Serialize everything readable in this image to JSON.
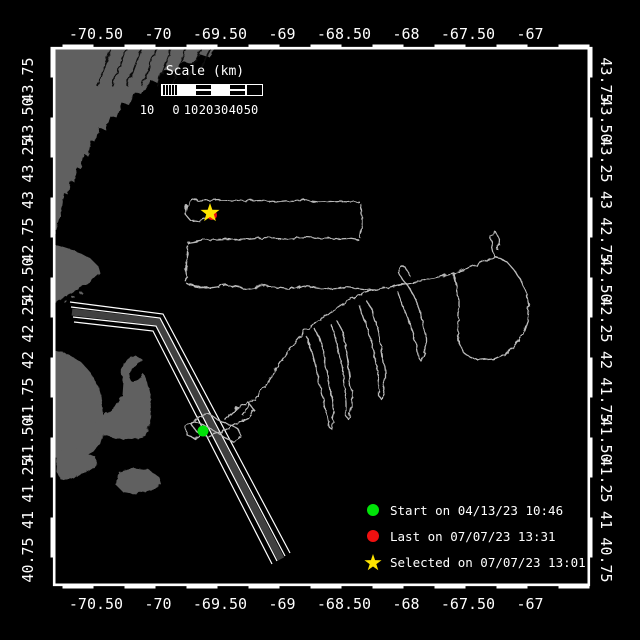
{
  "axes": {
    "lon_labels": [
      "-70.50",
      "-70",
      "-69.50",
      "-69",
      "-68.50",
      "-68",
      "-67.50",
      "-67"
    ],
    "lat_labels": [
      "43.75",
      "43.50",
      "43.25",
      "43",
      "42.75",
      "42.50",
      "42.25",
      "42",
      "41.75",
      "41.50",
      "41.25",
      "41",
      "40.75"
    ]
  },
  "scale_bar": {
    "title": "Scale (km)",
    "tick_labels": [
      "10",
      "0",
      "10",
      "20",
      "30",
      "40",
      "50"
    ],
    "segment_styles": [
      "hatch",
      "solid",
      "stripe",
      "solid",
      "stripe",
      "hollow"
    ]
  },
  "legend": {
    "items": [
      {
        "marker": "start-dot",
        "shape": "dot",
        "color": "#00e408",
        "label": "Start on 04/13/23 10:46"
      },
      {
        "marker": "last-dot",
        "shape": "dot",
        "color": "#f01010",
        "label": "Last on 07/07/23 13:31"
      },
      {
        "marker": "selected-star",
        "shape": "star",
        "color": "#ffe400",
        "label": "Selected on 07/07/23 13:01"
      }
    ]
  },
  "map": {
    "colors": {
      "background": "#000000",
      "land": "#606060",
      "river": "#0a0a0a",
      "track": "#bbbbbb",
      "frame": "#ffffff",
      "corridor_band": "#404040",
      "corridor_line": "#ffffff",
      "start": "#00e408",
      "last": "#f01010",
      "selected": "#ffe400"
    },
    "markers": {
      "start": {
        "x": 203,
        "y": 431,
        "r": 5.5
      },
      "last": {
        "x": 212,
        "y": 215,
        "r": 5
      },
      "selected": {
        "x": 210,
        "y": 213,
        "R": 10,
        "r": 4
      }
    },
    "land": [
      [
        [
          53,
          47
        ],
        [
          215,
          47
        ],
        [
          208,
          56
        ],
        [
          199,
          53
        ],
        [
          191,
          63
        ],
        [
          182,
          60
        ],
        [
          173,
          72
        ],
        [
          163,
          69
        ],
        [
          157,
          82
        ],
        [
          149,
          79
        ],
        [
          141,
          94
        ],
        [
          133,
          91
        ],
        [
          128,
          104
        ],
        [
          121,
          102
        ],
        [
          116,
          117
        ],
        [
          109,
          115
        ],
        [
          104,
          129
        ],
        [
          98,
          127
        ],
        [
          95,
          142
        ],
        [
          90,
          140
        ],
        [
          87,
          155
        ],
        [
          83,
          153
        ],
        [
          80,
          168
        ],
        [
          76,
          166
        ],
        [
          73,
          181
        ],
        [
          70,
          179
        ],
        [
          67,
          194
        ],
        [
          63,
          192
        ],
        [
          61,
          207
        ],
        [
          58,
          218
        ],
        [
          55,
          228
        ],
        [
          53,
          236
        ]
      ],
      [
        [
          53,
          243
        ],
        [
          66,
          247
        ],
        [
          79,
          252
        ],
        [
          90,
          258
        ],
        [
          97,
          265
        ],
        [
          99,
          272
        ],
        [
          92,
          279
        ],
        [
          82,
          285
        ],
        [
          70,
          292
        ],
        [
          59,
          298
        ],
        [
          53,
          302
        ]
      ],
      [
        [
          53,
          349
        ],
        [
          67,
          353
        ],
        [
          80,
          361
        ],
        [
          90,
          372
        ],
        [
          97,
          385
        ],
        [
          101,
          399
        ],
        [
          103,
          414
        ],
        [
          103,
          429
        ],
        [
          99,
          441
        ],
        [
          92,
          450
        ],
        [
          81,
          456
        ],
        [
          68,
          458
        ],
        [
          56,
          457
        ],
        [
          53,
          456
        ]
      ],
      [
        [
          88,
          426
        ],
        [
          102,
          416
        ],
        [
          114,
          406
        ],
        [
          121,
          394
        ],
        [
          122,
          380
        ],
        [
          120,
          368
        ],
        [
          125,
          359
        ],
        [
          134,
          354
        ],
        [
          141,
          358
        ],
        [
          137,
          365
        ],
        [
          130,
          368
        ],
        [
          128,
          376
        ],
        [
          132,
          382
        ],
        [
          138,
          379
        ],
        [
          142,
          372
        ],
        [
          146,
          379
        ],
        [
          149,
          393
        ],
        [
          150,
          409
        ],
        [
          149,
          425
        ],
        [
          144,
          435
        ],
        [
          132,
          439
        ],
        [
          116,
          438
        ],
        [
          101,
          433
        ]
      ],
      [
        [
          58,
          449
        ],
        [
          75,
          448
        ],
        [
          95,
          456
        ],
        [
          97,
          463
        ],
        [
          85,
          471
        ],
        [
          70,
          477
        ],
        [
          60,
          479
        ],
        [
          55,
          470
        ],
        [
          56,
          456
        ]
      ],
      [
        [
          118,
          471
        ],
        [
          133,
          467
        ],
        [
          148,
          469
        ],
        [
          158,
          476
        ],
        [
          160,
          483
        ],
        [
          150,
          489
        ],
        [
          135,
          493
        ],
        [
          122,
          491
        ],
        [
          115,
          484
        ],
        [
          116,
          476
        ]
      ]
    ],
    "islets": [
      [
        64,
        300
      ],
      [
        72,
        296
      ],
      [
        80,
        292
      ]
    ],
    "rivers": [
      [
        [
          110,
          47
        ],
        [
          96,
          85
        ]
      ],
      [
        [
          125,
          47
        ],
        [
          111,
          85
        ]
      ],
      [
        [
          140,
          47
        ],
        [
          126,
          85
        ]
      ],
      [
        [
          155,
          47
        ],
        [
          141,
          85
        ]
      ],
      [
        [
          170,
          47
        ],
        [
          156,
          85
        ]
      ],
      [
        [
          185,
          47
        ],
        [
          171,
          85
        ]
      ],
      [
        [
          200,
          47
        ],
        [
          186,
          78
        ]
      ],
      [
        [
          210,
          47
        ],
        [
          200,
          66
        ]
      ]
    ],
    "corridor": {
      "outer1": [
        [
          70,
          302
        ],
        [
          163,
          314
        ],
        [
          290,
          553
        ]
      ],
      "edge1": [
        [
          71,
          307
        ],
        [
          160,
          318
        ],
        [
          285,
          556
        ]
      ],
      "center": [
        [
          72,
          312
        ],
        [
          158,
          322
        ],
        [
          281,
          559
        ]
      ],
      "edge2": [
        [
          73,
          317
        ],
        [
          156,
          326
        ],
        [
          277,
          561
        ]
      ],
      "outer2": [
        [
          74,
          322
        ],
        [
          153,
          331
        ],
        [
          272,
          564
        ]
      ]
    },
    "track": [
      [
        [
          203,
          431
        ],
        [
          194,
          438
        ],
        [
          186,
          434
        ],
        [
          184,
          426
        ],
        [
          192,
          420
        ],
        [
          203,
          424
        ],
        [
          213,
          430
        ],
        [
          223,
          436
        ],
        [
          233,
          441
        ],
        [
          241,
          436
        ],
        [
          237,
          428
        ],
        [
          227,
          423
        ],
        [
          217,
          419
        ],
        [
          208,
          413
        ],
        [
          198,
          415
        ],
        [
          190,
          423
        ],
        [
          196,
          431
        ],
        [
          207,
          436
        ],
        [
          218,
          432
        ],
        [
          228,
          427
        ],
        [
          238,
          421
        ],
        [
          247,
          417
        ],
        [
          253,
          409
        ],
        [
          248,
          402
        ],
        [
          239,
          405
        ],
        [
          231,
          412
        ],
        [
          224,
          419
        ]
      ],
      [
        [
          241,
          414
        ],
        [
          247,
          406
        ],
        [
          254,
          398
        ],
        [
          261,
          389
        ],
        [
          267,
          380
        ],
        [
          273,
          371
        ],
        [
          279,
          362
        ],
        [
          285,
          353
        ],
        [
          292,
          344
        ],
        [
          298,
          337
        ],
        [
          304,
          331
        ]
      ],
      [
        [
          304,
          331
        ],
        [
          316,
          321
        ],
        [
          328,
          312
        ],
        [
          340,
          304
        ],
        [
          352,
          297
        ],
        [
          364,
          291
        ],
        [
          373,
          289
        ]
      ],
      [
        [
          187,
          284
        ],
        [
          205,
          287
        ],
        [
          225,
          284
        ],
        [
          245,
          288
        ],
        [
          265,
          285
        ],
        [
          285,
          288
        ],
        [
          305,
          285
        ],
        [
          325,
          288
        ],
        [
          345,
          286
        ],
        [
          362,
          288
        ],
        [
          373,
          289
        ]
      ],
      [
        [
          373,
          289
        ],
        [
          385,
          287
        ],
        [
          397,
          284
        ],
        [
          409,
          282
        ],
        [
          421,
          279
        ],
        [
          433,
          277
        ],
        [
          445,
          274
        ],
        [
          456,
          271
        ],
        [
          466,
          268
        ],
        [
          476,
          264
        ],
        [
          486,
          259
        ],
        [
          494,
          256
        ]
      ],
      [
        [
          186,
          282
        ],
        [
          185,
          270
        ],
        [
          186,
          256
        ],
        [
          186,
          244
        ]
      ],
      [
        [
          186,
          242
        ],
        [
          206,
          239
        ],
        [
          226,
          238
        ],
        [
          246,
          239
        ],
        [
          266,
          237
        ],
        [
          286,
          238
        ],
        [
          306,
          236
        ],
        [
          326,
          238
        ],
        [
          346,
          237
        ],
        [
          358,
          239
        ]
      ],
      [
        [
          359,
          237
        ],
        [
          361,
          224
        ],
        [
          361,
          210
        ],
        [
          360,
          203
        ]
      ],
      [
        [
          359,
          201
        ],
        [
          339,
          200
        ],
        [
          319,
          201
        ],
        [
          299,
          199
        ],
        [
          279,
          201
        ],
        [
          259,
          199
        ],
        [
          239,
          200
        ],
        [
          219,
          199
        ],
        [
          199,
          200
        ],
        [
          192,
          199
        ]
      ],
      [
        [
          192,
          199
        ],
        [
          186,
          205
        ],
        [
          184,
          213
        ],
        [
          189,
          219
        ],
        [
          197,
          220
        ],
        [
          205,
          217
        ],
        [
          212,
          215
        ]
      ],
      [
        [
          306,
          336
        ],
        [
          311,
          352
        ],
        [
          315,
          368
        ],
        [
          319,
          384
        ],
        [
          323,
          400
        ],
        [
          326,
          414
        ],
        [
          328,
          426
        ],
        [
          331,
          428
        ],
        [
          333,
          414
        ],
        [
          331,
          398
        ],
        [
          328,
          382
        ],
        [
          325,
          366
        ],
        [
          322,
          350
        ],
        [
          319,
          337
        ],
        [
          314,
          328
        ]
      ],
      [
        [
          331,
          324
        ],
        [
          335,
          340
        ],
        [
          339,
          356
        ],
        [
          342,
          372
        ],
        [
          344,
          388
        ],
        [
          345,
          402
        ],
        [
          345,
          415
        ],
        [
          348,
          419
        ],
        [
          351,
          406
        ],
        [
          351,
          390
        ],
        [
          349,
          374
        ],
        [
          347,
          358
        ],
        [
          344,
          342
        ],
        [
          341,
          329
        ],
        [
          336,
          320
        ]
      ],
      [
        [
          359,
          305
        ],
        [
          364,
          320
        ],
        [
          369,
          336
        ],
        [
          373,
          352
        ],
        [
          376,
          368
        ],
        [
          378,
          382
        ],
        [
          378,
          395
        ],
        [
          381,
          399
        ],
        [
          384,
          386
        ],
        [
          384,
          370
        ],
        [
          382,
          354
        ],
        [
          379,
          338
        ],
        [
          375,
          322
        ],
        [
          371,
          308
        ],
        [
          365,
          299
        ]
      ],
      [
        [
          396,
          290
        ],
        [
          401,
          304
        ],
        [
          407,
          318
        ],
        [
          412,
          332
        ],
        [
          416,
          346
        ],
        [
          418,
          357
        ],
        [
          421,
          361
        ],
        [
          425,
          351
        ],
        [
          425,
          337
        ],
        [
          422,
          322
        ],
        [
          418,
          308
        ],
        [
          413,
          295
        ],
        [
          407,
          285
        ],
        [
          401,
          278
        ],
        [
          397,
          271
        ],
        [
          399,
          265
        ],
        [
          405,
          267
        ],
        [
          409,
          275
        ]
      ],
      [
        [
          452,
          272
        ],
        [
          456,
          286
        ],
        [
          458,
          300
        ],
        [
          458,
          314
        ],
        [
          457,
          328
        ],
        [
          458,
          342
        ],
        [
          463,
          352
        ],
        [
          471,
          357
        ],
        [
          481,
          359
        ],
        [
          493,
          358
        ],
        [
          504,
          353
        ],
        [
          514,
          345
        ],
        [
          522,
          333
        ],
        [
          527,
          319
        ],
        [
          528,
          305
        ],
        [
          525,
          291
        ],
        [
          520,
          279
        ],
        [
          513,
          269
        ],
        [
          506,
          261
        ],
        [
          499,
          257
        ],
        [
          494,
          256
        ],
        [
          492,
          247
        ],
        [
          490,
          236
        ],
        [
          494,
          230
        ],
        [
          498,
          238
        ],
        [
          497,
          250
        ]
      ]
    ]
  }
}
